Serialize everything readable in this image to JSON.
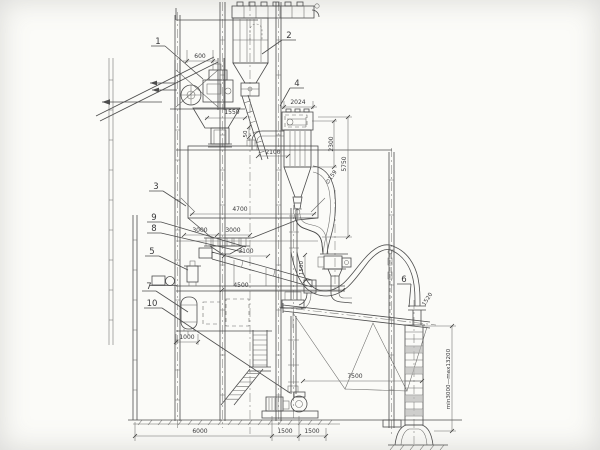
{
  "drawing": {
    "type": "plant-elevation-drawing",
    "paper_color": "#fbfbf8",
    "line_color": "#4d4d4d",
    "callouts": [
      {
        "label": "1"
      },
      {
        "label": "2"
      },
      {
        "label": "3"
      },
      {
        "label": "4"
      },
      {
        "label": "5"
      },
      {
        "label": "6"
      },
      {
        "label": "7"
      },
      {
        "label": "8"
      },
      {
        "label": "9"
      },
      {
        "label": "10"
      }
    ],
    "dimensions": {
      "hoist_width": "600",
      "hopper_width": "1550",
      "chute_offset": "50",
      "collector_width": "2024",
      "duct_drop": "2100",
      "collector_height": "2300",
      "cyclone_drop": "5750",
      "silo_width": "4700",
      "bay_left": "3000",
      "bay_right": "3000",
      "screw_length": "3100",
      "platform_span": "4500",
      "wall_offset": "1000",
      "boom_span": "7500",
      "bend_radius": "1520",
      "riser_height": "1500",
      "pipe_dia": "∅159",
      "chute_travel": "min3000—max13200",
      "base_main": "6000",
      "base_bay1": "1500",
      "base_bay2": "1500"
    }
  }
}
